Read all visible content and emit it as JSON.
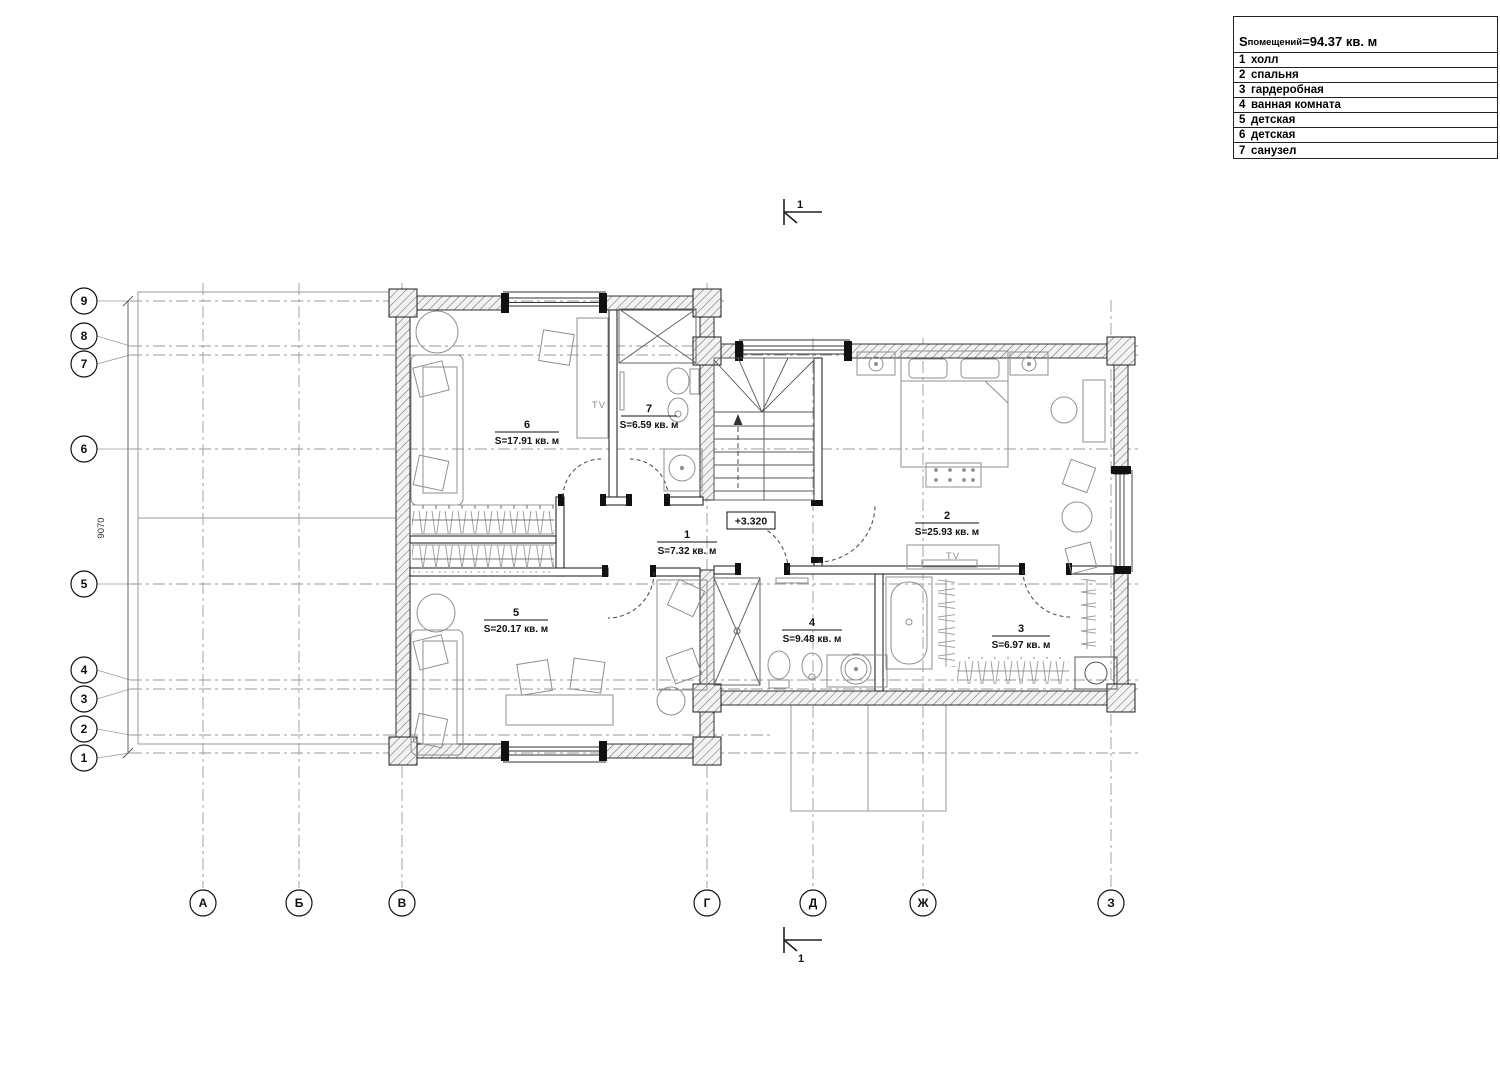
{
  "legend": {
    "area_total": {
      "prefix": "S",
      "sub": "помещений",
      "value": "=94.37 кв. м"
    },
    "rooms": [
      {
        "num": "1",
        "name": "холл"
      },
      {
        "num": "2",
        "name": "спальня"
      },
      {
        "num": "3",
        "name": "гардеробная"
      },
      {
        "num": "4",
        "name": "ванная комната"
      },
      {
        "num": "5",
        "name": "детская"
      },
      {
        "num": "6",
        "name": "детская"
      },
      {
        "num": "7",
        "name": "санузел"
      }
    ]
  },
  "plan": {
    "room_labels": {
      "r1": {
        "num": "1",
        "area": "S=7.32 кв. м"
      },
      "r2": {
        "num": "2",
        "area": "S=25.93 кв. м"
      },
      "r3": {
        "num": "3",
        "area": "S=6.97 кв. м"
      },
      "r4": {
        "num": "4",
        "area": "S=9.48 кв. м"
      },
      "r5": {
        "num": "5",
        "area": "S=20.17 кв. м"
      },
      "r6": {
        "num": "6",
        "area": "S=17.91 кв. м"
      },
      "r7": {
        "num": "7",
        "area": "S=6.59 кв. м"
      }
    },
    "elevation": "+3.320",
    "tv": "TV",
    "dimension_left": "9070",
    "section_label": "1"
  },
  "axes": {
    "rows": [
      "9",
      "8",
      "7",
      "6",
      "5",
      "4",
      "3",
      "2",
      "1"
    ],
    "cols": [
      "А",
      "Б",
      "В",
      "Г",
      "Д",
      "Ж",
      "З"
    ]
  },
  "colors": {
    "wall": "#1c1c1c",
    "furniture": "#8f8f8f",
    "grid": "#9a9a9a",
    "background": "#ffffff"
  }
}
